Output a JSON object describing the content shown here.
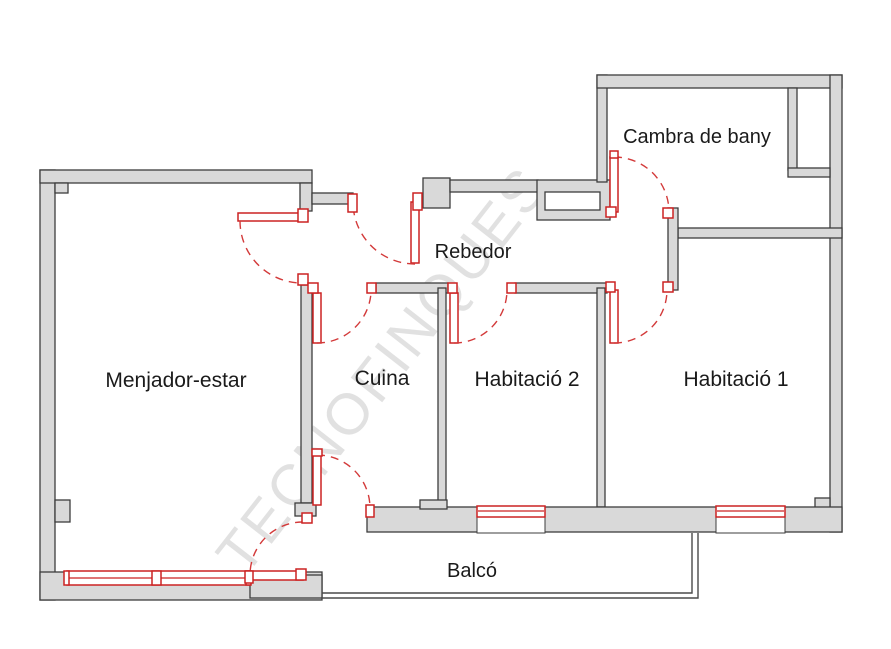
{
  "plan": {
    "rooms": [
      {
        "id": "menjador",
        "label": "Menjador-estar"
      },
      {
        "id": "cuina",
        "label": "Cuina"
      },
      {
        "id": "habitacio2",
        "label": "Habitació 2"
      },
      {
        "id": "habitacio1",
        "label": "Habitació 1"
      },
      {
        "id": "rebedor",
        "label": "Rebedor"
      },
      {
        "id": "bany",
        "label": "Cambra de bany"
      },
      {
        "id": "balco",
        "label": "Balcó"
      }
    ],
    "watermark": {
      "text": "TECNOFINQUES"
    },
    "colors": {
      "background": "#ffffff",
      "wall_fill": "#d9d9d9",
      "wall_stroke": "#3d3d3d",
      "fixture_red": "#cc2222",
      "door_arc_red": "#d33a3a",
      "watermark_gray": "#c9c9c9",
      "label_text": "#1a1a1a"
    }
  }
}
